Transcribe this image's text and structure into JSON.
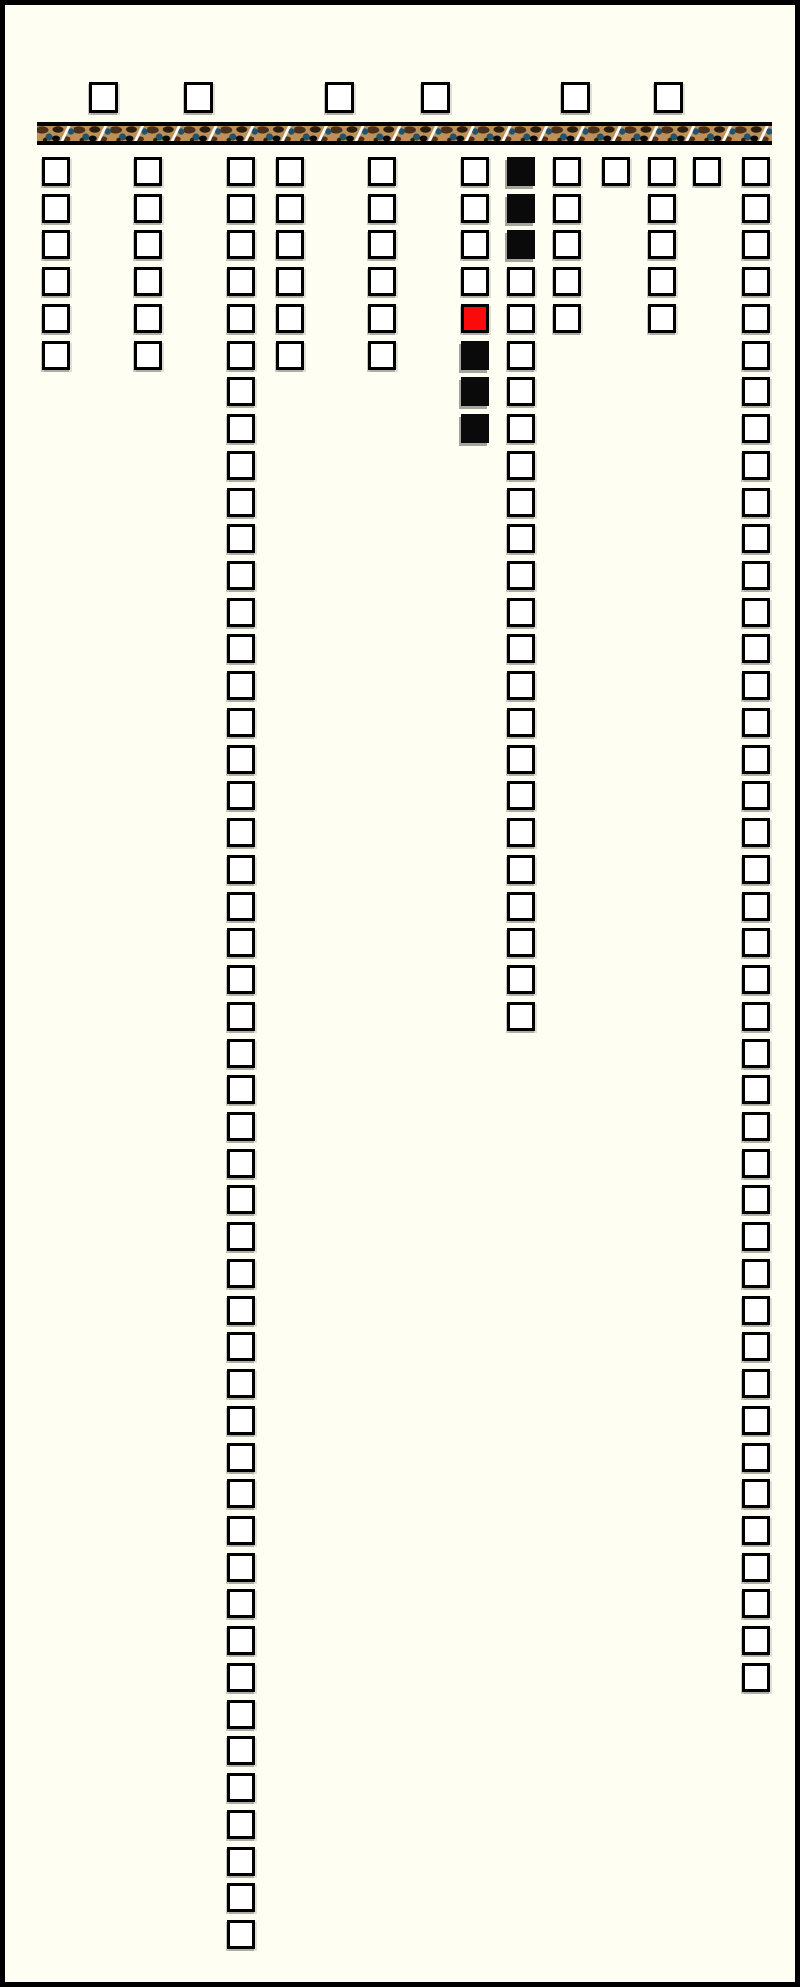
{
  "window": {
    "width": 800,
    "height": 1987,
    "background": "#FFFEF2",
    "border_color": "#000000",
    "border_width": 5
  },
  "header_row": {
    "y": 77,
    "cell_w": 29,
    "cell_h": 31,
    "state": "unchecked",
    "x_positions": [
      84,
      179,
      320,
      416,
      556,
      649
    ]
  },
  "divider_bar": {
    "x": 32,
    "y": 117,
    "width": 735,
    "height": 23,
    "edge_color": "#000000",
    "base_color": "#BE9059",
    "blob_brown": "#4A301B",
    "blob_dark_brown": "#2B1D0C",
    "blob_blue": "#1E5470",
    "blob_black": "#0A0A0A",
    "slash_color": "#FFFFFF",
    "slash_period": 36.75,
    "strip_height": 15
  },
  "checkbox_grid": {
    "start_y": 152,
    "row_pitch": 36.73,
    "cell_w": 28,
    "cell_h": 29,
    "state_colors": {
      "unchecked": "#FFFFFF",
      "checked_black": "#0A0A0A",
      "checked_red": "#FA0A0A"
    },
    "columns": [
      {
        "id": "col-01",
        "x": 37,
        "runs": [
          [
            "unchecked",
            6
          ]
        ]
      },
      {
        "id": "col-02",
        "x": 129,
        "runs": [
          [
            "unchecked",
            6
          ]
        ]
      },
      {
        "id": "col-03",
        "x": 222,
        "runs": [
          [
            "unchecked",
            49
          ]
        ]
      },
      {
        "id": "col-04",
        "x": 271,
        "runs": [
          [
            "unchecked",
            6
          ]
        ]
      },
      {
        "id": "col-05",
        "x": 363,
        "runs": [
          [
            "unchecked",
            6
          ]
        ]
      },
      {
        "id": "col-06",
        "x": 456,
        "runs": [
          [
            "unchecked",
            4
          ],
          [
            "checked_red",
            1
          ],
          [
            "checked_black",
            3
          ]
        ]
      },
      {
        "id": "col-07",
        "x": 502,
        "runs": [
          [
            "checked_black",
            3
          ],
          [
            "unchecked",
            21
          ]
        ]
      },
      {
        "id": "col-08",
        "x": 548,
        "runs": [
          [
            "unchecked",
            5
          ]
        ]
      },
      {
        "id": "col-09",
        "x": 597,
        "runs": [
          [
            "unchecked",
            1
          ]
        ]
      },
      {
        "id": "col-10",
        "x": 643,
        "runs": [
          [
            "unchecked",
            5
          ]
        ]
      },
      {
        "id": "col-11",
        "x": 688,
        "runs": [
          [
            "unchecked",
            1
          ]
        ]
      },
      {
        "id": "col-12",
        "x": 737,
        "runs": [
          [
            "unchecked",
            42
          ]
        ]
      }
    ]
  }
}
